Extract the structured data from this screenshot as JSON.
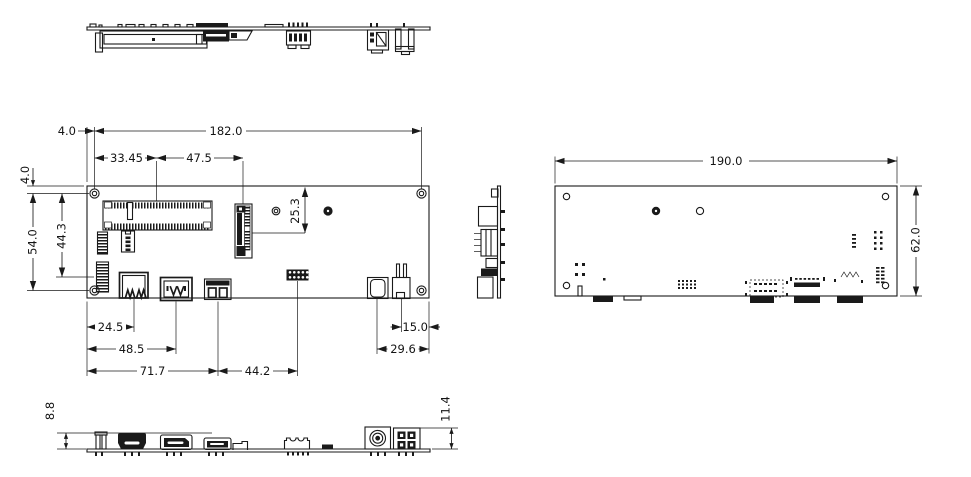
{
  "colors": {
    "background": "#ffffff",
    "line": "#1a1a1a"
  },
  "dimensions": {
    "plan_top": {
      "edge_to_hole": "4.0",
      "hole_span": "182.0",
      "hole_to_sodimm": "33.45",
      "sodimm_to_m2": "47.5"
    },
    "plan_left": {
      "edge_to_hole": "4.0",
      "hole_span": "54.0",
      "hole_to_header": "44.3"
    },
    "plan_inner": {
      "edge_to_m2": "25.3"
    },
    "plan_bottom": {
      "usb_offset": "24.5",
      "dp_offset": "48.5",
      "usb3_offset": "71.7",
      "header_offset": "44.2",
      "power_offset": "15.0",
      "dcjack_offset": "29.6"
    },
    "bottom_view": {
      "board_width": "190.0",
      "board_height": "62.0"
    },
    "front_view": {
      "io_height": "8.8",
      "power_height": "11.4"
    }
  }
}
